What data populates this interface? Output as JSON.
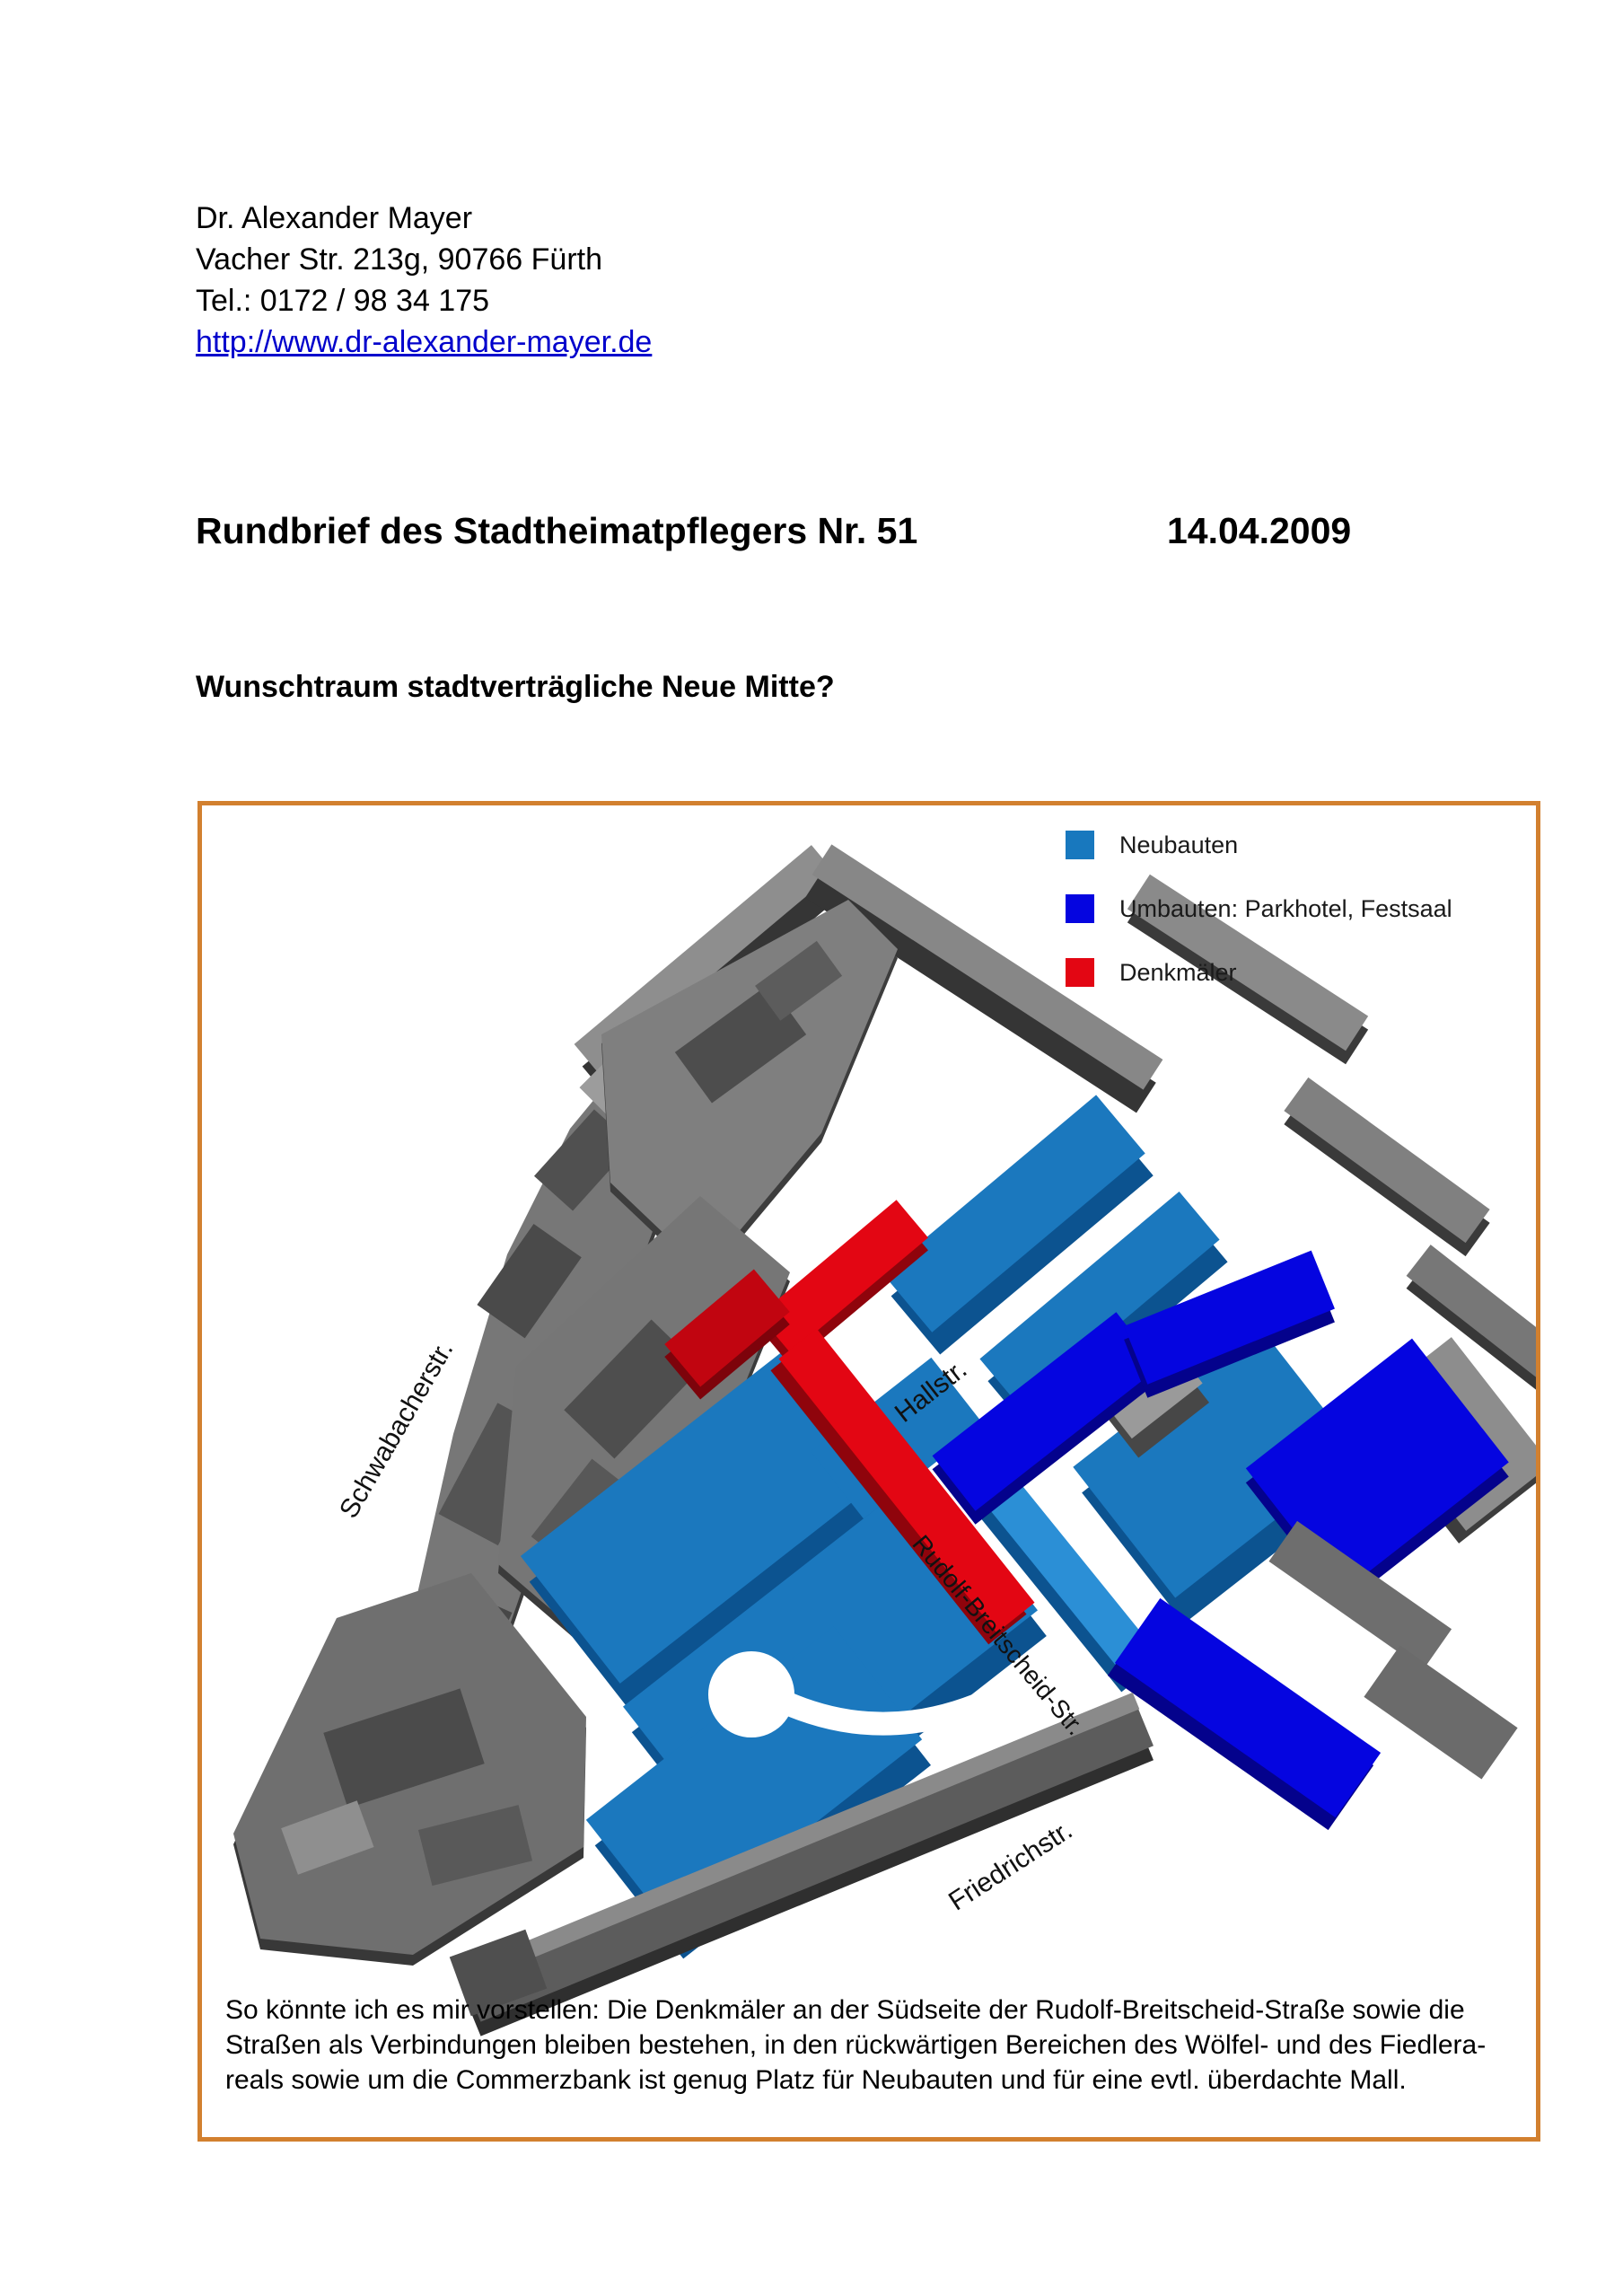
{
  "document": {
    "author": {
      "name": "Dr. Alexander Mayer",
      "address": "Vacher Str. 213g, 90766 Fürth",
      "phone": "Tel.: 0172 / 98 34 175",
      "website": "http://www.dr-alexander-mayer.de"
    },
    "title": "Rundbrief des Stadtheimatpflegers Nr. 51",
    "date": "14.04.2009",
    "subtitle": "Wunschtraum stadtverträgliche Neue Mitte?"
  },
  "figure": {
    "border_color": "#d2802f",
    "legend": [
      {
        "label": "Neubauten",
        "color": "#1878be"
      },
      {
        "label": "Umbauten: Parkhotel, Festsaal",
        "color": "#0505e0"
      },
      {
        "label": "Denkmäler",
        "color": "#e30613"
      }
    ],
    "streets": [
      "Schwabacherstr.",
      "Hallstr.",
      "Rudolf-Breitscheid-Str.",
      "Friedrichstr."
    ],
    "caption": {
      "lines": [
        "So könnte ich es mir vorstellen: Die Denkmäler an der Südseite der Rudolf-Breitscheid-Straße sowie die",
        "Straßen als Verbindungen bleiben bestehen, in den rückwärtigen Bereichen des Wölfel- und des Fiedlera-",
        "reals sowie um die Commerzbank ist genug Platz für Neubauten und für eine evtl. überdachte Mall."
      ]
    }
  }
}
